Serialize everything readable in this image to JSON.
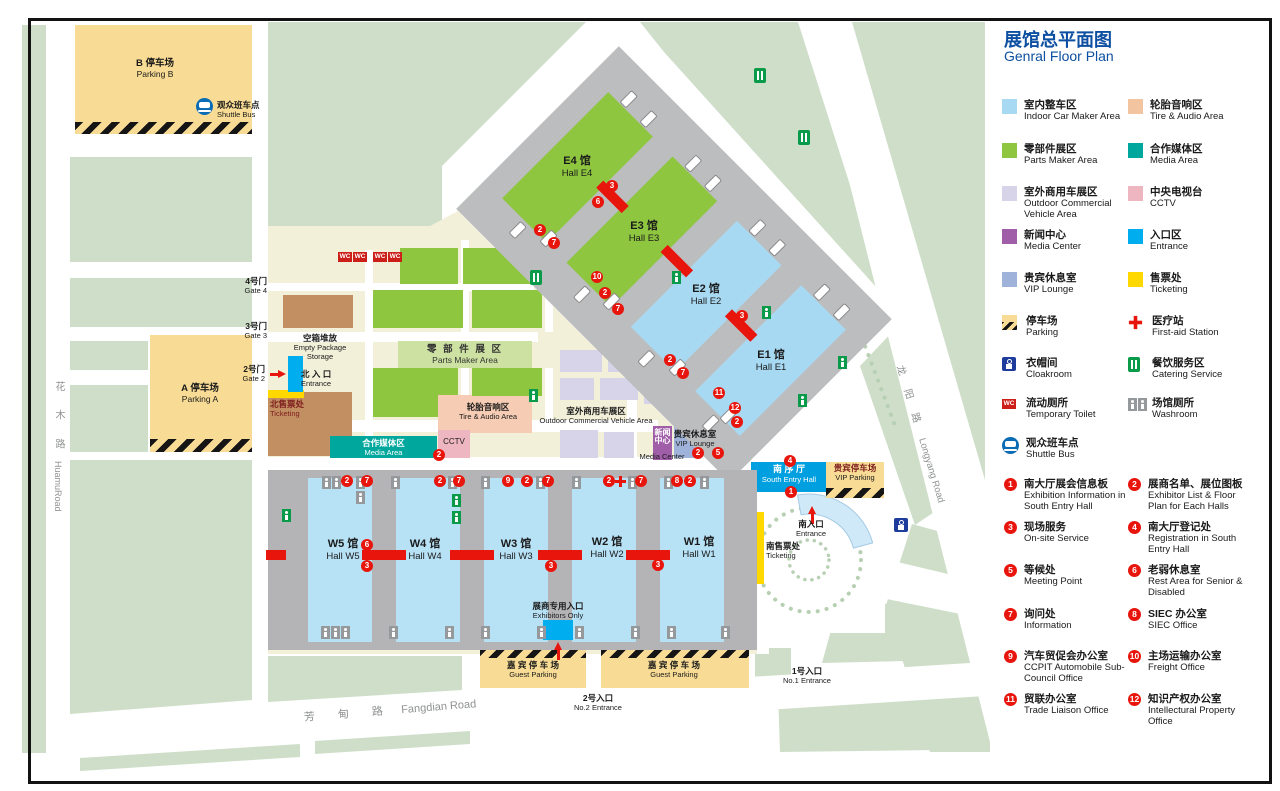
{
  "title": {
    "zh": "展馆总平面图",
    "en": "Genral Floor Plan"
  },
  "legend": {
    "areas": [
      {
        "color": "#a8d9f3",
        "zh": "室内整车区",
        "en": "Indoor Car Maker Area"
      },
      {
        "color": "#f2c4a0",
        "zh": "轮胎音响区",
        "en": "Tire & Audio Area"
      },
      {
        "color": "#8fc640",
        "zh": "零部件展区",
        "en": "Parts Maker Area"
      },
      {
        "color": "#00a79d",
        "zh": "合作媒体区",
        "en": "Media Area"
      },
      {
        "color": "#d7d4ea",
        "zh": "室外商用车展区",
        "en": "Outdoor Commercial Vehicle Area"
      },
      {
        "color": "#eeb6c0",
        "zh": "中央电视台",
        "en": "CCTV"
      },
      {
        "color": "#a05da8",
        "zh": "新闻中心",
        "en": "Media Center"
      },
      {
        "color": "#00aeef",
        "zh": "入口区",
        "en": "Entrance"
      },
      {
        "color": "#9fb3da",
        "zh": "贵宾休息室",
        "en": "VIP Lounge"
      },
      {
        "color": "#ffd800",
        "zh": "售票处",
        "en": "Ticketing"
      }
    ],
    "facilities": [
      {
        "icon": "parking-icon",
        "zh": "停车场",
        "en": "Parking"
      },
      {
        "icon": "first-aid-icon",
        "zh": "医疗站",
        "en": "First-aid Station"
      },
      {
        "icon": "cloakroom-icon",
        "zh": "衣帽间",
        "en": "Cloakroom"
      },
      {
        "icon": "catering-icon",
        "zh": "餐饮服务区",
        "en": "Catering Service"
      },
      {
        "icon": "wc-icon",
        "zh": "流动厕所",
        "en": "Temporary Toilet"
      },
      {
        "icon": "washroom-icon",
        "zh": "场馆厕所",
        "en": "Washroom"
      },
      {
        "icon": "shuttle-icon",
        "zh": "观众班车点",
        "en": "Shuttle Bus"
      }
    ],
    "numbered": [
      {
        "n": "1",
        "zh": "南大厅展会信息板",
        "en": "Exhibition Information in South Entry Hall"
      },
      {
        "n": "2",
        "zh": "展商名单、展位图板",
        "en": "Exhibitor List & Floor Plan for Each Halls"
      },
      {
        "n": "3",
        "zh": "现场服务",
        "en": "On-site Service"
      },
      {
        "n": "4",
        "zh": "南大厅登记处",
        "en": "Registration in South Entry Hall"
      },
      {
        "n": "5",
        "zh": "等候处",
        "en": "Meeting Point"
      },
      {
        "n": "6",
        "zh": "老弱休息室",
        "en": "Rest  Area for Senior & Disabled"
      },
      {
        "n": "7",
        "zh": "询问处",
        "en": "Information"
      },
      {
        "n": "8",
        "zh": "SIEC 办公室",
        "en": "SIEC Office"
      },
      {
        "n": "9",
        "zh": "汽车贸促会办公室",
        "en": "CCPIT Automobile Sub-Council Office"
      },
      {
        "n": "10",
        "zh": "主场运输办公室",
        "en": "Freight Office"
      },
      {
        "n": "11",
        "zh": "贸联办公室",
        "en": "Trade Liaison Office"
      },
      {
        "n": "12",
        "zh": "知识产权办公室",
        "en": "Intellectural Property Office"
      }
    ]
  },
  "map": {
    "wc": "WC",
    "labels": {
      "parking_b": {
        "zh": "B 停车场",
        "en": "Parking B"
      },
      "shuttle": {
        "zh": "观众班车点",
        "en": "Shuttle Bus"
      },
      "huamu": {
        "zh": "花 木 路",
        "en": "HuamuRoad"
      },
      "gate4": {
        "zh": "4号门",
        "en": "Gate 4"
      },
      "gate3": {
        "zh": "3号门",
        "en": "Gate 3"
      },
      "gate2": {
        "zh": "2号门",
        "en": "Gate 2"
      },
      "parking_a": {
        "zh": "A 停车场",
        "en": "Parking A"
      },
      "empty_storage": {
        "zh": "空箱堆放",
        "en1": "Empty Package",
        "en2": "Storage"
      },
      "north_entrance": {
        "zh": "北 入 口",
        "en": "Entrance"
      },
      "north_ticketing": {
        "zh": "北售票处",
        "en": "Ticketing"
      },
      "parts_band": {
        "zh": "零 部 件 展 区",
        "en": "Parts Maker Area"
      },
      "tire": {
        "zh": "轮胎音响区",
        "en": "Tire & Audio Area"
      },
      "outdoor": {
        "zh": "室外商用车展区",
        "en": "Outdoor Commercial Vehicle Area"
      },
      "media_area": {
        "zh": "合作媒体区",
        "en": "Media Area"
      },
      "cctv": {
        "en": "CCTV"
      },
      "media_center": {
        "zh": "新闻中心",
        "en": "Media Center"
      },
      "vip_lounge": {
        "zh": "贵宾休息室",
        "en": "VIP Lounge"
      },
      "south_entry": {
        "zh": "南 序 厅",
        "en": "South Entry Hall"
      },
      "vip_parking": {
        "zh": "贵宾停车场",
        "en": "VIP Parking"
      },
      "south_entrance": {
        "zh": "南入口",
        "en": "Entrance"
      },
      "south_ticketing": {
        "zh": "南售票处",
        "en": "Ticketing"
      },
      "longyang": {
        "zh": "龙 阳 路",
        "en": "Longyang Road"
      },
      "fangdian": {
        "zh": "芳 甸 路",
        "en": "Fangdian Road"
      },
      "exhibitors": {
        "zh": "展商专用入口",
        "en": "Exhibitors Only"
      },
      "guest_parking": {
        "zh": "嘉 宾 停 车 场",
        "en": "Guest Parking"
      },
      "no2": {
        "zh": "2号入口",
        "en": "No.2 Entrance"
      },
      "no1": {
        "zh": "1号入口",
        "en": "No.1 Entrance"
      }
    },
    "halls": [
      {
        "zh": "E4 馆",
        "en": "Hall E4"
      },
      {
        "zh": "E3 馆",
        "en": "Hall E3"
      },
      {
        "zh": "E2 馆",
        "en": "Hall E2"
      },
      {
        "zh": "E1 馆",
        "en": "Hall E1"
      },
      {
        "zh": "W5 馆",
        "en": "Hall W5"
      },
      {
        "zh": "W4 馆",
        "en": "Hall W4"
      },
      {
        "zh": "W3 馆",
        "en": "Hall W3"
      },
      {
        "zh": "W2 馆",
        "en": "Hall W2"
      },
      {
        "zh": "W1 馆",
        "en": "Hall W1"
      }
    ],
    "markers": [
      {
        "n": "3"
      },
      {
        "n": "6"
      },
      {
        "n": "2"
      },
      {
        "n": "7"
      },
      {
        "n": "10"
      },
      {
        "n": "2"
      },
      {
        "n": "7"
      },
      {
        "n": "3"
      },
      {
        "n": "2"
      },
      {
        "n": "7"
      },
      {
        "n": "11"
      },
      {
        "n": "12"
      },
      {
        "n": "2"
      },
      {
        "n": "2"
      },
      {
        "n": "2"
      },
      {
        "n": "5"
      },
      {
        "n": "4"
      },
      {
        "n": "1"
      },
      {
        "n": "2"
      },
      {
        "n": "7"
      },
      {
        "n": "2"
      },
      {
        "n": "7"
      },
      {
        "n": "9"
      },
      {
        "n": "2"
      },
      {
        "n": "7"
      },
      {
        "n": "2"
      },
      {
        "n": "7"
      },
      {
        "n": "8"
      },
      {
        "n": "2"
      },
      {
        "n": "6"
      },
      {
        "n": "3"
      },
      {
        "n": "3"
      },
      {
        "n": "3"
      }
    ]
  }
}
